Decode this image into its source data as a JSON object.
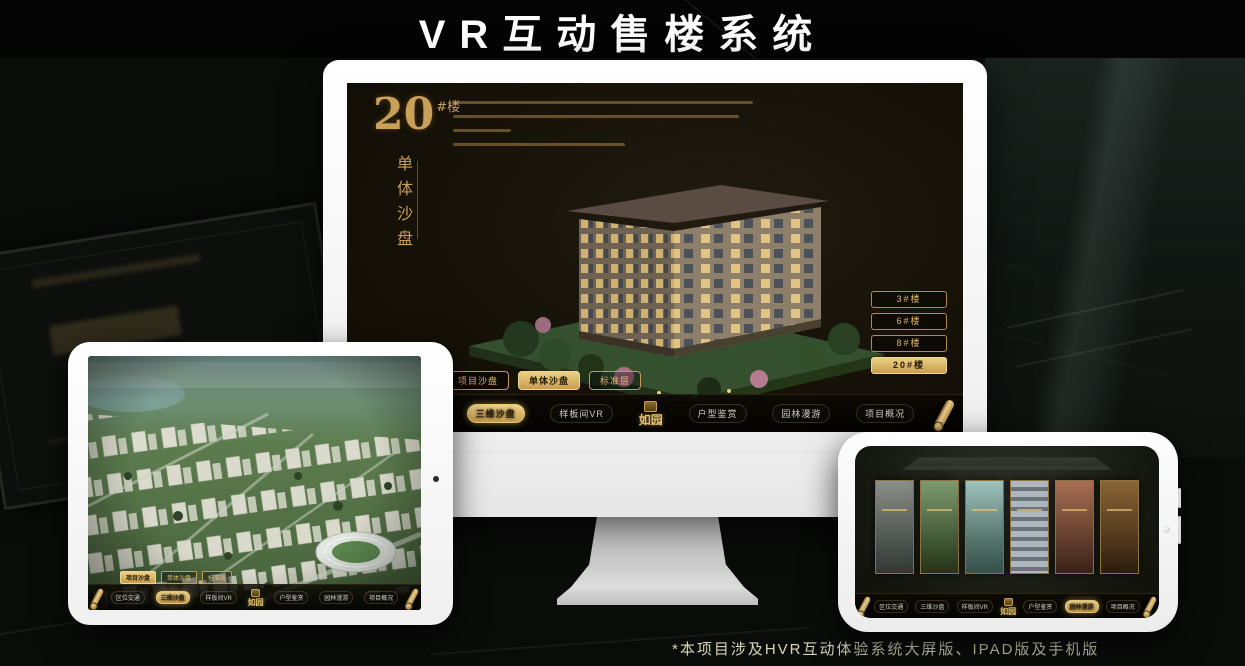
{
  "page": {
    "title": "VR互动售楼系统",
    "footnote": "*本项目涉及HVR互动体验系统大屏版、IPAD版及手机版"
  },
  "brand": {
    "logo": "如园"
  },
  "colors": {
    "gold": "#c9a05a",
    "gold_bright": "#ecd085",
    "screen_bg": "#171208",
    "background": "#0a0c0a",
    "title_text": "#ffffff",
    "footnote_text": "#d9d4bb"
  },
  "monitor": {
    "heading": {
      "number": "20",
      "unit": "#楼",
      "subtitle": "单体沙盘"
    },
    "floor_buttons": [
      {
        "label": "3#楼",
        "active": false
      },
      {
        "label": "6#楼",
        "active": false
      },
      {
        "label": "8#楼",
        "active": false
      },
      {
        "label": "20#楼",
        "active": true
      }
    ],
    "tabs": [
      {
        "label": "项目沙盘",
        "active": false
      },
      {
        "label": "单体沙盘",
        "active": true
      },
      {
        "label": "标准层",
        "active": false
      }
    ],
    "menu": [
      {
        "label": "区位交通",
        "active": false
      },
      {
        "label": "三维沙盘",
        "active": true
      },
      {
        "label": "样板间VR",
        "active": false
      },
      {
        "label": "户型鉴赏",
        "active": false
      },
      {
        "label": "园林漫游",
        "active": false
      },
      {
        "label": "项目概况",
        "active": false
      }
    ]
  },
  "tablet": {
    "tabs": [
      {
        "label": "项目沙盘",
        "active": true
      },
      {
        "label": "单体沙盘",
        "active": false
      },
      {
        "label": "标准层",
        "active": false
      }
    ],
    "menu": [
      {
        "label": "区位交通",
        "active": false
      },
      {
        "label": "三维沙盘",
        "active": true
      },
      {
        "label": "样板间VR",
        "active": false
      },
      {
        "label": "户型鉴赏",
        "active": false
      },
      {
        "label": "园林漫游",
        "active": false
      },
      {
        "label": "项目概况",
        "active": false
      }
    ]
  },
  "phone": {
    "menu": [
      {
        "label": "区位交通",
        "active": false
      },
      {
        "label": "三维沙盘",
        "active": false
      },
      {
        "label": "样板间VR",
        "active": false
      },
      {
        "label": "户型鉴赏",
        "active": false
      },
      {
        "label": "园林漫游",
        "active": true
      },
      {
        "label": "项目概况",
        "active": false
      }
    ]
  }
}
